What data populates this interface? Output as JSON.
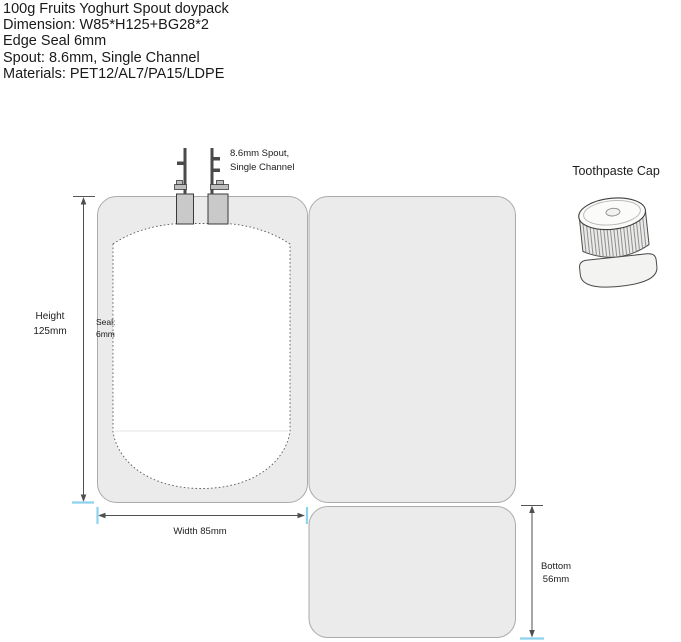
{
  "header": {
    "lines": [
      "100g Fruits Yoghurt Spout doypack",
      "Dimension: W85*H125+BG28*2",
      "Edge Seal 6mm",
      "Spout: 8.6mm, Single Channel",
      "Materials: PET12/AL7/PA15/LDPE"
    ]
  },
  "labels": {
    "spout_line1": "8.6mm Spout,",
    "spout_line2": "Single Channel",
    "height_line1": "Height",
    "height_line2": "125mm",
    "seal_line1": "Seal:",
    "seal_line2": "6mm",
    "width": "Width 85mm",
    "bottom_line1": "Bottom",
    "bottom_line2": "56mm",
    "cap": "Toothpaste Cap"
  },
  "colors": {
    "panel_fill": "#ebebeb",
    "panel_stroke": "#ababab",
    "interior_fill": "#ffffff",
    "dash_color": "#5a5a5a",
    "spout_fill": "#c9c9c9",
    "spout_dark": "#4a4a4a",
    "dim_line": "#4f4f4f",
    "tick_blue": "#8ed2ee",
    "text_color": "#1a1a1a"
  }
}
